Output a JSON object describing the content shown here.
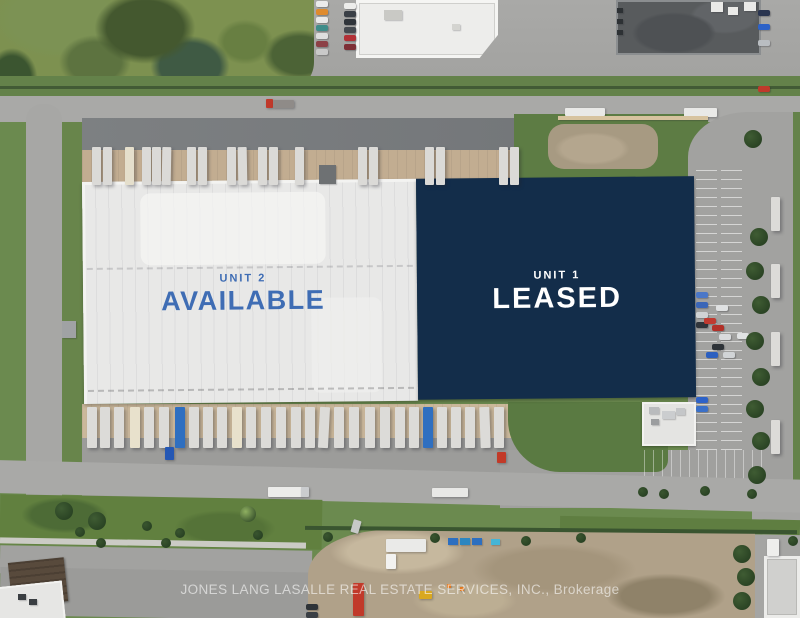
{
  "property": {
    "unit2": {
      "kicker": "UNIT 2",
      "status": "AVAILABLE"
    },
    "unit1": {
      "kicker": "UNIT 1",
      "status": "LEASED"
    },
    "credit": "JONES LANG LASALLE REAL ESTATE SERVICES, INC., Brokerage"
  },
  "colors": {
    "available_blue": "#3f6db4",
    "overlay_navy": "#132d4a",
    "leased_text": "#ffffff",
    "roof_white": "#e8e8e7"
  },
  "scene": {
    "trailers_north": [
      {
        "x": 92
      },
      {
        "x": 103
      },
      {
        "x": 125,
        "c": "#e5dfcc"
      },
      {
        "x": 142
      },
      {
        "x": 152
      },
      {
        "x": 162,
        "rot": 1
      },
      {
        "x": 187
      },
      {
        "x": 198
      },
      {
        "x": 227
      },
      {
        "x": 238,
        "rot": -1
      },
      {
        "x": 258
      },
      {
        "x": 269
      },
      {
        "x": 295
      },
      {
        "x": 358
      },
      {
        "x": 369
      },
      {
        "x": 425
      },
      {
        "x": 436
      },
      {
        "x": 499
      },
      {
        "x": 510
      }
    ],
    "trailers_south": [
      {
        "x": 87
      },
      {
        "x": 100
      },
      {
        "x": 114
      },
      {
        "x": 130,
        "c": "#e8e1cc"
      },
      {
        "x": 144
      },
      {
        "x": 159
      },
      {
        "x": 175,
        "c": "#2f6fc0"
      },
      {
        "x": 189
      },
      {
        "x": 203
      },
      {
        "x": 217
      },
      {
        "x": 232,
        "c": "#e8e1cc"
      },
      {
        "x": 246
      },
      {
        "x": 261
      },
      {
        "x": 276
      },
      {
        "x": 291
      },
      {
        "x": 305
      },
      {
        "x": 319,
        "rot": 3
      },
      {
        "x": 334
      },
      {
        "x": 349
      },
      {
        "x": 365
      },
      {
        "x": 380
      },
      {
        "x": 395
      },
      {
        "x": 409
      },
      {
        "x": 423,
        "c": "#2f6fc0"
      },
      {
        "x": 437
      },
      {
        "x": 451
      },
      {
        "x": 465
      },
      {
        "x": 480,
        "rot": -2
      },
      {
        "x": 494
      }
    ],
    "trailers_east": [
      {
        "y": 197
      },
      {
        "y": 264
      },
      {
        "y": 332
      },
      {
        "y": 420
      }
    ],
    "vehicles": [
      {
        "x": 266,
        "y": 99,
        "w": 7,
        "h": 9,
        "c": "#c0392b"
      },
      {
        "x": 273,
        "y": 100,
        "w": 21,
        "h": 8,
        "c": "#8f8b88"
      },
      {
        "x": 565,
        "y": 108,
        "w": 40,
        "h": 8,
        "c": "#e9e9e7"
      },
      {
        "x": 684,
        "y": 108,
        "w": 33,
        "h": 9,
        "c": "#e9e9e7"
      },
      {
        "x": 268,
        "y": 487,
        "w": 34,
        "h": 10,
        "c": "#ececea"
      },
      {
        "x": 301,
        "y": 487,
        "w": 8,
        "h": 10,
        "c": "#caccce"
      },
      {
        "x": 432,
        "y": 488,
        "w": 36,
        "h": 9,
        "c": "#e8e8e6"
      },
      {
        "x": 386,
        "y": 539,
        "w": 40,
        "h": 13,
        "c": "#eaeae8"
      },
      {
        "x": 386,
        "y": 554,
        "w": 10,
        "h": 15,
        "c": "#f2f2f0"
      },
      {
        "x": 353,
        "y": 583,
        "w": 11,
        "h": 33,
        "c": "#c13a2a"
      },
      {
        "x": 352,
        "y": 520,
        "w": 8,
        "h": 13,
        "c": "#c7c9c8",
        "rot": 16
      },
      {
        "x": 767,
        "y": 539,
        "w": 12,
        "h": 17,
        "c": "#eeeeec"
      },
      {
        "x": 165,
        "y": 447,
        "w": 9,
        "h": 13,
        "c": "#2457b4"
      },
      {
        "x": 497,
        "y": 452,
        "w": 9,
        "h": 11,
        "c": "#c23a28"
      },
      {
        "x": 419,
        "y": 591,
        "w": 13,
        "h": 8,
        "c": "#d9a81f"
      }
    ],
    "cars": [
      {
        "x": 316,
        "y": 1,
        "c": "#ebebeb"
      },
      {
        "x": 316,
        "y": 9,
        "c": "#df8b2e"
      },
      {
        "x": 316,
        "y": 17,
        "c": "#e9e9e9"
      },
      {
        "x": 316,
        "y": 25,
        "c": "#3f8d8a"
      },
      {
        "x": 316,
        "y": 33,
        "c": "#dedede"
      },
      {
        "x": 316,
        "y": 41,
        "c": "#8c4046"
      },
      {
        "x": 316,
        "y": 49,
        "c": "#c9c9c9"
      },
      {
        "x": 344,
        "y": 3,
        "c": "#ededeb"
      },
      {
        "x": 344,
        "y": 11,
        "c": "#3a3f46"
      },
      {
        "x": 344,
        "y": 19,
        "c": "#2f343a"
      },
      {
        "x": 344,
        "y": 27,
        "c": "#454a50"
      },
      {
        "x": 344,
        "y": 35,
        "c": "#b23036"
      },
      {
        "x": 344,
        "y": 44,
        "c": "#7e2f36"
      },
      {
        "x": 758,
        "y": 10,
        "c": "#2a3550"
      },
      {
        "x": 758,
        "y": 24,
        "c": "#2d62c8"
      },
      {
        "x": 758,
        "y": 40,
        "c": "#b9bdc1"
      },
      {
        "x": 758,
        "y": 86,
        "c": "#c0392b"
      },
      {
        "x": 696,
        "y": 292,
        "c": "#4a77c8"
      },
      {
        "x": 696,
        "y": 302,
        "c": "#3a66b8"
      },
      {
        "x": 696,
        "y": 312,
        "c": "#d0d3d5"
      },
      {
        "x": 696,
        "y": 322,
        "c": "#30353b"
      },
      {
        "x": 704,
        "y": 318,
        "c": "#c03a30"
      },
      {
        "x": 712,
        "y": 325,
        "c": "#b23028"
      },
      {
        "x": 719,
        "y": 334,
        "c": "#d9dbdd"
      },
      {
        "x": 712,
        "y": 344,
        "c": "#2e3338"
      },
      {
        "x": 706,
        "y": 352,
        "c": "#2b5fc0"
      },
      {
        "x": 723,
        "y": 352,
        "c": "#d1d4d6"
      },
      {
        "x": 696,
        "y": 397,
        "c": "#2d62c8"
      },
      {
        "x": 696,
        "y": 406,
        "c": "#3a70c8"
      },
      {
        "x": 737,
        "y": 333,
        "c": "#e0e2e3"
      },
      {
        "x": 716,
        "y": 305,
        "c": "#dfe1e2"
      },
      {
        "x": 306,
        "y": 604,
        "c": "#2e3338"
      },
      {
        "x": 306,
        "y": 612,
        "c": "#3a3f45"
      }
    ],
    "trees": [
      {
        "x": 744,
        "y": 130
      },
      {
        "x": 750,
        "y": 228
      },
      {
        "x": 746,
        "y": 262
      },
      {
        "x": 752,
        "y": 296
      },
      {
        "x": 746,
        "y": 332
      },
      {
        "x": 752,
        "y": 368
      },
      {
        "x": 746,
        "y": 400
      },
      {
        "x": 752,
        "y": 432
      },
      {
        "x": 748,
        "y": 466
      },
      {
        "x": 733,
        "y": 545
      },
      {
        "x": 737,
        "y": 568
      },
      {
        "x": 733,
        "y": 592
      },
      {
        "x": 55,
        "y": 502
      },
      {
        "x": 88,
        "y": 512
      },
      {
        "x": 240,
        "y": 506,
        "d": 16,
        "c": "#8fb061"
      }
    ],
    "bushes": [
      {
        "x": 75,
        "y": 527
      },
      {
        "x": 96,
        "y": 538
      },
      {
        "x": 142,
        "y": 521
      },
      {
        "x": 161,
        "y": 538
      },
      {
        "x": 253,
        "y": 530
      },
      {
        "x": 323,
        "y": 532
      },
      {
        "x": 430,
        "y": 533
      },
      {
        "x": 521,
        "y": 536
      },
      {
        "x": 576,
        "y": 533
      },
      {
        "x": 638,
        "y": 487
      },
      {
        "x": 659,
        "y": 489
      },
      {
        "x": 700,
        "y": 486
      },
      {
        "x": 747,
        "y": 489
      },
      {
        "x": 788,
        "y": 536
      },
      {
        "x": 175,
        "y": 528
      }
    ],
    "misc": [
      {
        "x": 319,
        "y": 165,
        "w": 17,
        "h": 19,
        "c": "#6e7173"
      },
      {
        "x": 62,
        "y": 321,
        "w": 14,
        "h": 17,
        "c": "#a0a2a4"
      },
      {
        "x": 558,
        "y": 116,
        "w": 150,
        "h": 4,
        "c": "#d7c39f"
      },
      {
        "x": 448,
        "y": 538,
        "w": 10,
        "h": 7,
        "c": "#2d6fc0"
      },
      {
        "x": 460,
        "y": 538,
        "w": 10,
        "h": 7,
        "c": "#2d86c0"
      },
      {
        "x": 472,
        "y": 538,
        "w": 10,
        "h": 7,
        "c": "#2d6fc0"
      },
      {
        "x": 491,
        "y": 539,
        "w": 9,
        "h": 6,
        "c": "#45b5d6"
      },
      {
        "x": 617,
        "y": 8,
        "w": 6,
        "h": 5,
        "c": "#2d3134"
      },
      {
        "x": 617,
        "y": 19,
        "w": 6,
        "h": 5,
        "c": "#2d3134"
      },
      {
        "x": 617,
        "y": 30,
        "w": 6,
        "h": 5,
        "c": "#2d3134"
      },
      {
        "x": 711,
        "y": 2,
        "w": 12,
        "h": 10,
        "c": "#eaeae8"
      },
      {
        "x": 728,
        "y": 7,
        "w": 10,
        "h": 8,
        "c": "#eaeae8"
      },
      {
        "x": 744,
        "y": 2,
        "w": 12,
        "h": 9,
        "c": "#eaeae8"
      },
      {
        "x": 384,
        "y": 10,
        "w": 18,
        "h": 10,
        "c": "#c9c9c5"
      },
      {
        "x": 452,
        "y": 24,
        "w": 8,
        "h": 6,
        "c": "#d4d4d0"
      },
      {
        "x": 649,
        "y": 407,
        "w": 10,
        "h": 7,
        "c": "#b9bbbd"
      },
      {
        "x": 662,
        "y": 411,
        "w": 13,
        "h": 8,
        "c": "#cbcdcf"
      },
      {
        "x": 651,
        "y": 419,
        "w": 8,
        "h": 6,
        "c": "#9b9d9f"
      },
      {
        "x": 676,
        "y": 408,
        "w": 9,
        "h": 7,
        "c": "#c4c6c8"
      },
      {
        "x": 18,
        "y": 594,
        "w": 8,
        "h": 6,
        "c": "#3a3e42"
      },
      {
        "x": 29,
        "y": 599,
        "w": 8,
        "h": 6,
        "c": "#3a3e42"
      },
      {
        "x": 447,
        "y": 584,
        "w": 4,
        "h": 4,
        "c": "#e07820"
      },
      {
        "x": 460,
        "y": 587,
        "w": 4,
        "h": 4,
        "c": "#e07820"
      }
    ]
  }
}
